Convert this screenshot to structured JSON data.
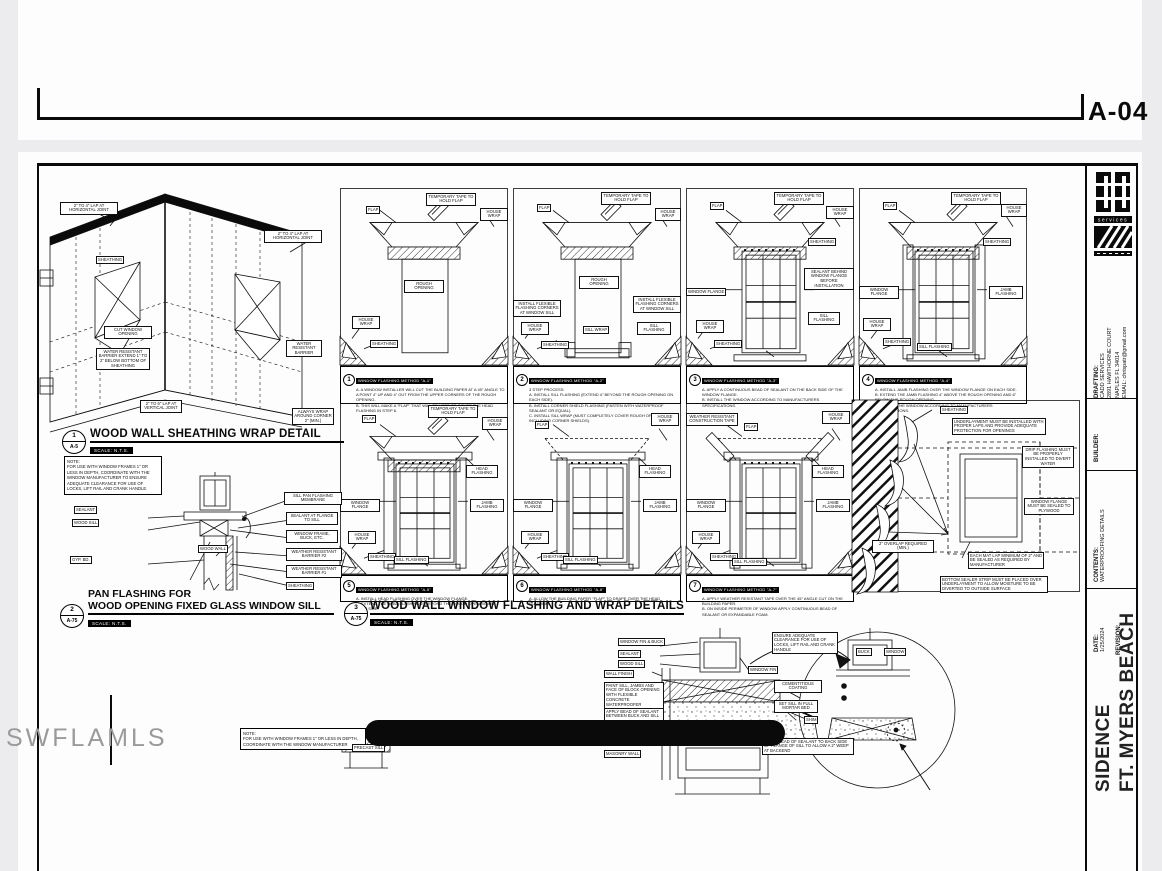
{
  "viewer": {
    "prev_sheet_number": "A-04"
  },
  "watermark": "SWFLAMLS",
  "title_block": {
    "logo_text": "services",
    "drafting_label": "DRAFTING:",
    "drafting_lines": [
      "CADD SERVICES",
      "2891 HAWTHORNE COURT",
      "NAPLES FL 34014",
      "EMAIL: chrispatr@gmail.com"
    ],
    "builder_label": "BUILDER:",
    "contents_label": "CONTENTS:",
    "contents_value": "WATERPROOFING DETAILS",
    "date_label": "DATE:",
    "date_value": "1/25/2024",
    "revision_label": "REVISION:",
    "project_line1": "SIDENCE",
    "project_line2": "FT. MYERS BEACH"
  },
  "details": {
    "d1": {
      "num": "1",
      "ref": "A-5",
      "title": "WOOD WALL SHEATHING WRAP DETAIL",
      "scale": "SCALE: N.T.S."
    },
    "d2": {
      "num": "2",
      "ref": "A-75",
      "title_line1": "PAN FLASHING FOR",
      "title_line2": "WOOD OPENING FIXED GLASS WINDOW SILL",
      "scale": "SCALE: N.T.S."
    },
    "d3": {
      "num": "3",
      "ref": "A-75",
      "title": "WOOD WALL WINDOW FLASHING AND WRAP DETAILS",
      "scale": "SCALE: N.T.S."
    }
  },
  "strings": {
    "flap": "FLAP",
    "temp_tape": "TEMPORARY TAPE TO HOLD FLAP",
    "house_wrap": "HOUSE WRAP",
    "sheathing": "SHEATHING",
    "rough_opening": "ROUGH OPENING",
    "window_flange": "WINDOW FLANGE",
    "jamb_flashing": "JAMB FLASHING",
    "head_flashing": "HEAD FLASHING",
    "sill_flashing": "SILL FLASHING",
    "sill_wrap": "SILL WRAP",
    "flex_corner": "INSTALL FLEXIBLE FLASHING CORNERS AT WINDOW SILL",
    "sealant_behind": "SEALANT BEHIND WINDOW FLANGE BEFORE INSTALLATION",
    "wr_tape": "WEATHER RESISTANT CONSTRUCTION TAPE"
  },
  "iso": {
    "lap_horiz": "2\" TO 4\" LAP AT HORIZONTAL JOINT",
    "sheathing": "SHEATHING",
    "cut_opening": "CUT WINDOW OPENING",
    "wrb_extend": "WATER RESISTANT BARRIER EXTEND 1\" TO 2\" BELOW BOTTOM OF SHEATHING",
    "lap_vert": "2\" TO 6\" LAP AT VERTICAL JOINT",
    "wrb": "WATER RESISTANT BARRIER",
    "corner_wrap": "ALWAYS WRAP AROUND CORNER 2\" (MIN.)"
  },
  "pan_detail": {
    "note": "NOTE:\nFOR USE WITH WINDOW FRAMES 1\" OR LESS IN DEPTH, COORDINATE WITH THE WINDOW MANUFACTURER TO ENSURE ADEQUATE CLEARANCE FOR USE OF LOCKS, LIFT RAIL AND CRANK HANDLE.",
    "sealant": "SEALANT",
    "wood_sill": "WOOD SILL",
    "gyp_bd": "GYP. BD.",
    "wood_wall": "WOOD WALL",
    "pan_membrane": "SILL PAN FLASHING MEMBRANE",
    "sealant_flange": "SEALANT AT FLANGE TO SILL",
    "frame_buck": "WINDOW FRAME, BUCK, ETC.",
    "wrb2": "WEATHER RESISTANT BARRIER #2",
    "wrb1": "WEATHER RESISTANT BARRIER #1",
    "sheathing": "SHEATHING"
  },
  "panels": {
    "p1": {
      "step": "1",
      "header": "WINDOW FLASHING METHOD \"A-1\"",
      "notes": "A. A WINDOW INSTALLER WILL CUT THE BUILDING PAPER AT A 45° ANGLE TO A POINT 4\" UP AND 4\" OUT FROM THE UPPER CORNERS OF THE ROUGH OPENING.\nB. THIS WILL MAKE A \"FLAP\" THAT WILL BE USED TO COVER THE HEAD FLASHING IN STEP 6."
    },
    "p2": {
      "step": "2",
      "header": "WINDOW FLASHING METHOD \"A-2\"",
      "notes": "3 STEP PROCESS:\nA. INSTALL SILL FLASHING (EXTEND 4\" BEYOND THE ROUGH OPENING ON EACH SIDE).\nB. INSTALL CORNER SHIELD FLASHING (FASTEN WITH WATERPROOF SEALANT OR EQUAL).\nC. INSTALL SILL WRAP (MUST COMPLETELY COVER ROUGH OPENING SILL INCLUDING CORNER SHIELDS)."
    },
    "p3": {
      "step": "3",
      "header": "WINDOW FLASHING METHOD \"A-3\"",
      "notes": "A. APPLY A CONTINUOUS BEAD OF SEALANT ON THE BACK SIDE OF THE WINDOW FLANGE.\nB. INSTALL THE WINDOW ACCORDING TO MANUFACTURERS SPECIFICATIONS."
    },
    "p4": {
      "step": "4",
      "header": "WINDOW FLASHING METHOD \"A-4\"",
      "notes": "A. INSTALL JAMB FLASHING OVER THE WINDOW FLANGE ON EACH SIDE.\nB. EXTEND THE JAMB FLASHING 4\" ABOVE THE ROUGH OPENING AND 6\" BELOW THE ROUGH OPENING.\nC. INSTALL THE WINDOW ACCORDING TO MANUFACTURERS SPECIFICATIONS."
    },
    "p5": {
      "step": "5",
      "header": "WINDOW FLASHING METHOD \"A-5\"",
      "notes": "A. INSTALL HEAD FLASHING OVER THE WINDOW FLANGE.\nB. EXTEND THE HEAD FLASHING 2\" BEYOND THE ROUGH OPENING ON EACH SIDE."
    },
    "p6": {
      "step": "6",
      "header": "WINDOW FLASHING METHOD \"A-6\"",
      "notes": "A. ALLOW THE BUILDING PAPER \"FLAP\" TO DRAPE OVER THE HEAD FLASHING."
    },
    "p7": {
      "step": "7",
      "header": "WINDOW FLASHING METHOD \"A-7\"",
      "notes": "A. APPLY WEATHER RESISTANT TAPE OVER THE 45° ANGLE CUT ON THE BUILDING PAPER.\nB. ON INSIDE PERIMETER OF WINDOW APPLY CONTINUOUS BEAD OF SEALANT OR EXPANDABLE FOAM."
    },
    "p8": {
      "sheathing": "SHEATHING",
      "underlayment": "UNDERLAYMENT MUST BE INSTALLED WITH PROPER LAPS AND PROVIDE ADEQUATE PROTECTION FOR OPENINGS",
      "drip": "DRIP FLASHING MUST BE PROPERLY INSTALLED TO DIVERT WATER",
      "flange_sealed": "WINDOW FLANGE MUST BE SEALED TO PLYWOOD",
      "overlap": "2\" OVERLAP REQUIRED (MIN.)",
      "lap": "EACH MAT LAP MINIMUM OF 2\" AND BE SEALED AS REQUIRED BY MANUFACTURER",
      "bottom_strip": "BOTTOM SEALER STRIP MUST BE PLACED OVER UNDERLAYMENT TO ALLOW MOISTURE TO BE DIVERTED TO OUTSIDE SURFACE"
    }
  },
  "sill_detail": {
    "fin_buck": "WINDOW FIN & BUCK",
    "sealant": "SEALANT",
    "wood_sill": "WOOD SILL",
    "wall_finish": "WALL FINISH",
    "paint": "PAINT SILL, JAMBS AND FACE OF BLOCK OPENING WITH FLEXIBLE CONCRETE WATERPROOFER",
    "bead_buck": "APPLY BEAD OF SEALANT BETWEEN BUCK AND SILL",
    "precast": "PRECAST SILL",
    "masonry": "MASONRY WALL",
    "window_fin": "WINDOW FIN",
    "cement": "CEMENTITIOUS COATING",
    "mortar": "SET SILL IN FULL MORTAR BED",
    "clearance": "ENSURE ADEQUATE CLEARANCE FOR USE OF LOCKS, LIFT RAIL AND CRANK HANDLE",
    "buck": "BUCK",
    "window": "WINDOW",
    "shim": "SHIM",
    "weep": "APPLY BEAD OF SEALANT TO BACK SIDE OF FLANGE OF SILL TO ALLOW A 2\" WEEP AT BACKEND",
    "note2": "NOTE:\nFOR USE WITH WINDOW FRAMES 1\" OR LESS IN DEPTH, COORDINATE WITH THE WINDOW MANUFACTURER"
  }
}
